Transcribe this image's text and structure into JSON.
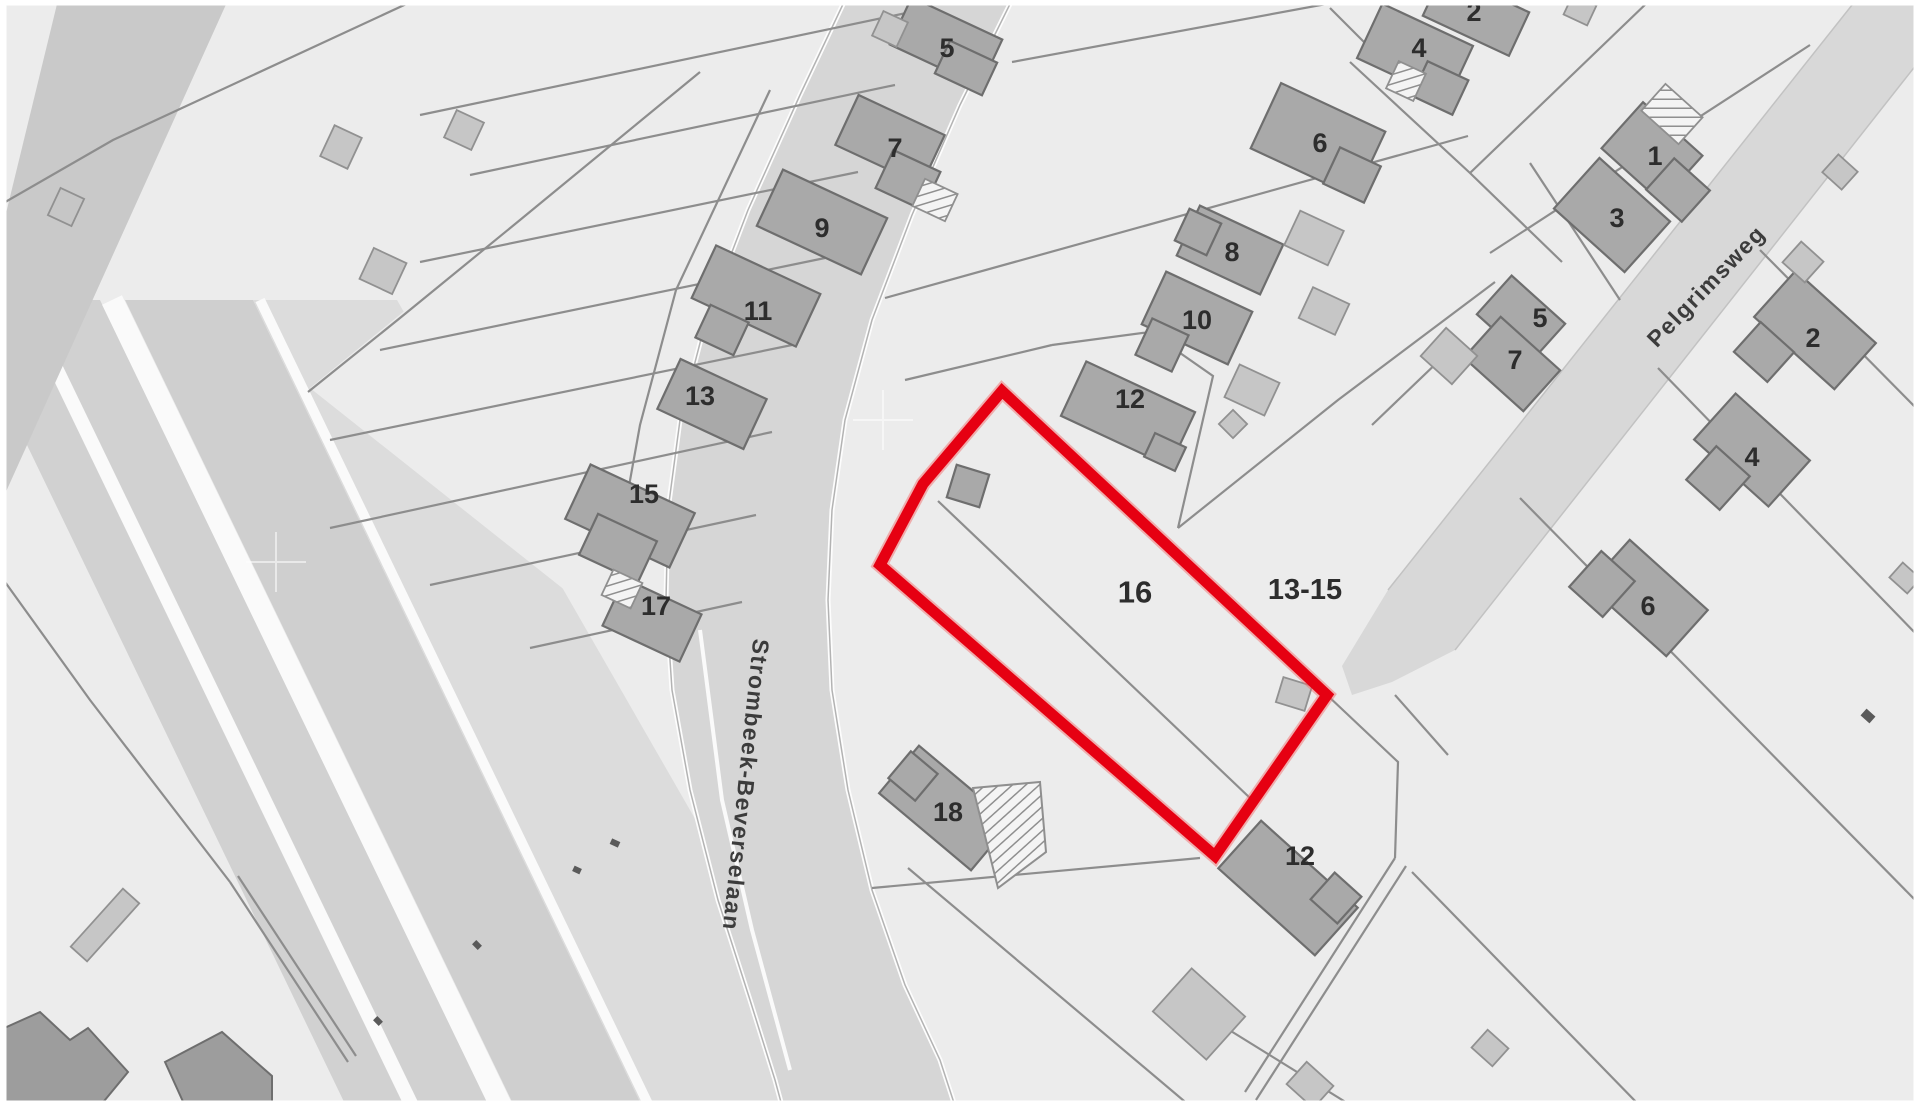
{
  "map": {
    "type": "cadastral-parcel-map",
    "highlighted_parcel": {
      "label": "16",
      "outline_color": "#e60012",
      "label_x": 1135,
      "label_y": 592,
      "label_size": 31
    },
    "adjacent_parcel_label": {
      "t": "13-15",
      "x": 1305,
      "y": 590,
      "s": 29
    },
    "streets": [
      {
        "t": "Strombeek-Beverselaan",
        "x": 746,
        "y": 785,
        "r": 96,
        "s": 23
      },
      {
        "t": "Pelgrimsweg",
        "x": 1706,
        "y": 286,
        "r": -46,
        "s": 23
      }
    ],
    "house_numbers": [
      {
        "t": "5",
        "x": 947,
        "y": 48
      },
      {
        "t": "7",
        "x": 895,
        "y": 148
      },
      {
        "t": "9",
        "x": 822,
        "y": 228
      },
      {
        "t": "11",
        "x": 758,
        "y": 311
      },
      {
        "t": "13",
        "x": 700,
        "y": 396
      },
      {
        "t": "15",
        "x": 644,
        "y": 494
      },
      {
        "t": "17",
        "x": 656,
        "y": 606
      },
      {
        "t": "6",
        "x": 1320,
        "y": 143
      },
      {
        "t": "8",
        "x": 1232,
        "y": 252
      },
      {
        "t": "10",
        "x": 1197,
        "y": 320
      },
      {
        "t": "12",
        "x": 1130,
        "y": 399
      },
      {
        "t": "4",
        "x": 1419,
        "y": 48
      },
      {
        "t": "2",
        "x": 1474,
        "y": 12
      },
      {
        "t": "1",
        "x": 1655,
        "y": 156
      },
      {
        "t": "3",
        "x": 1617,
        "y": 218
      },
      {
        "t": "5",
        "x": 1540,
        "y": 318
      },
      {
        "t": "7",
        "x": 1515,
        "y": 360
      },
      {
        "t": "2",
        "x": 1813,
        "y": 338
      },
      {
        "t": "4",
        "x": 1752,
        "y": 457
      },
      {
        "t": "6",
        "x": 1648,
        "y": 606
      },
      {
        "t": "18",
        "x": 948,
        "y": 812
      },
      {
        "t": "12",
        "x": 1300,
        "y": 856
      }
    ],
    "colors": {
      "parcel_background": "#ececec",
      "road_main": "#d6d6d6",
      "road_side": "#d8d8d8",
      "road_corridor": "#d1d1d1",
      "verge": "#dcdcdc",
      "corner_road": "#c9c9c9",
      "building_main": "#a9a9a9",
      "building_outline": "#6e6e6e",
      "outbuilding": "#c6c6c6",
      "parcel_line": "#8d8d8d",
      "highlight_red": "#e60012",
      "label_text": "#2d2d2d"
    }
  }
}
